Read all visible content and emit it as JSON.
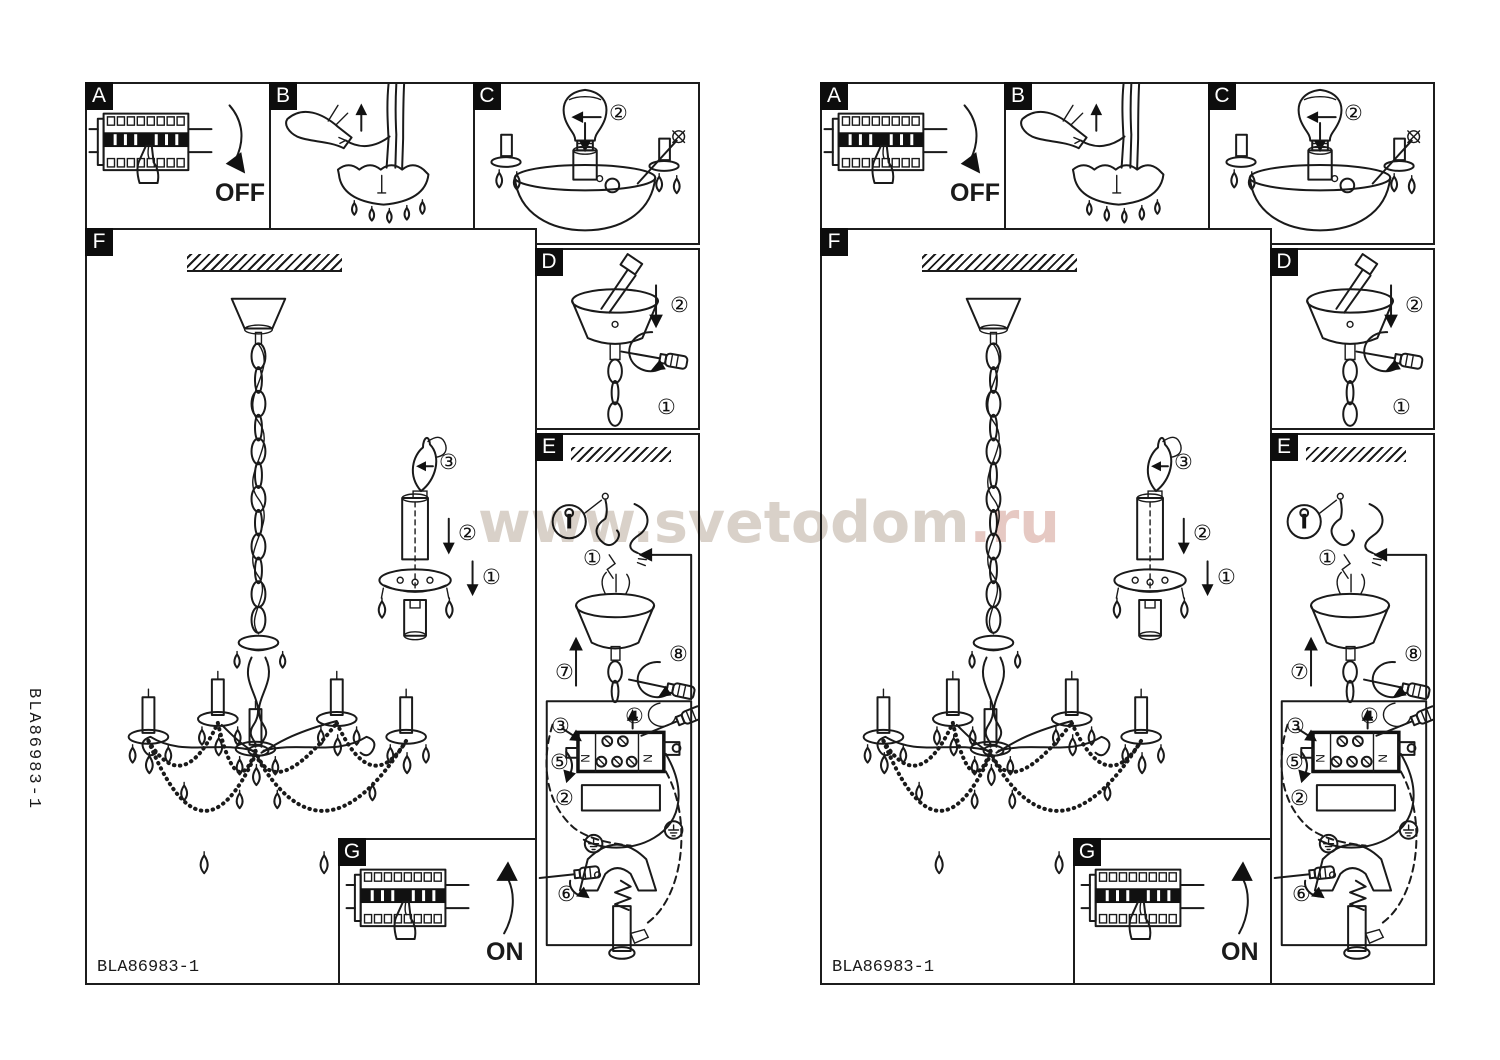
{
  "watermark": {
    "host": "www.svetodom",
    "tld": ".ru"
  },
  "side_code": "BLA86983-1",
  "page": {
    "model_code": "BLA86983-1",
    "labels": {
      "a": "A",
      "b": "B",
      "c": "C",
      "d": "D",
      "e": "E",
      "f": "F",
      "g": "G"
    },
    "off_label": "OFF",
    "on_label": "ON",
    "terminal_letters": {
      "left": "N",
      "right": "N"
    },
    "markers": {
      "c_shade": "②",
      "f_bulb": "③",
      "f_sleeve": "②",
      "f_cup": "①",
      "d_push": "②",
      "d_screw": "①",
      "e_hook": "①",
      "e_lift": "⑦",
      "e_side_screw": "⑧",
      "e_wire": "③",
      "e_term": "④",
      "e_bend": "⑤",
      "e_tuck": "②",
      "e_clamp": "⑥"
    }
  }
}
